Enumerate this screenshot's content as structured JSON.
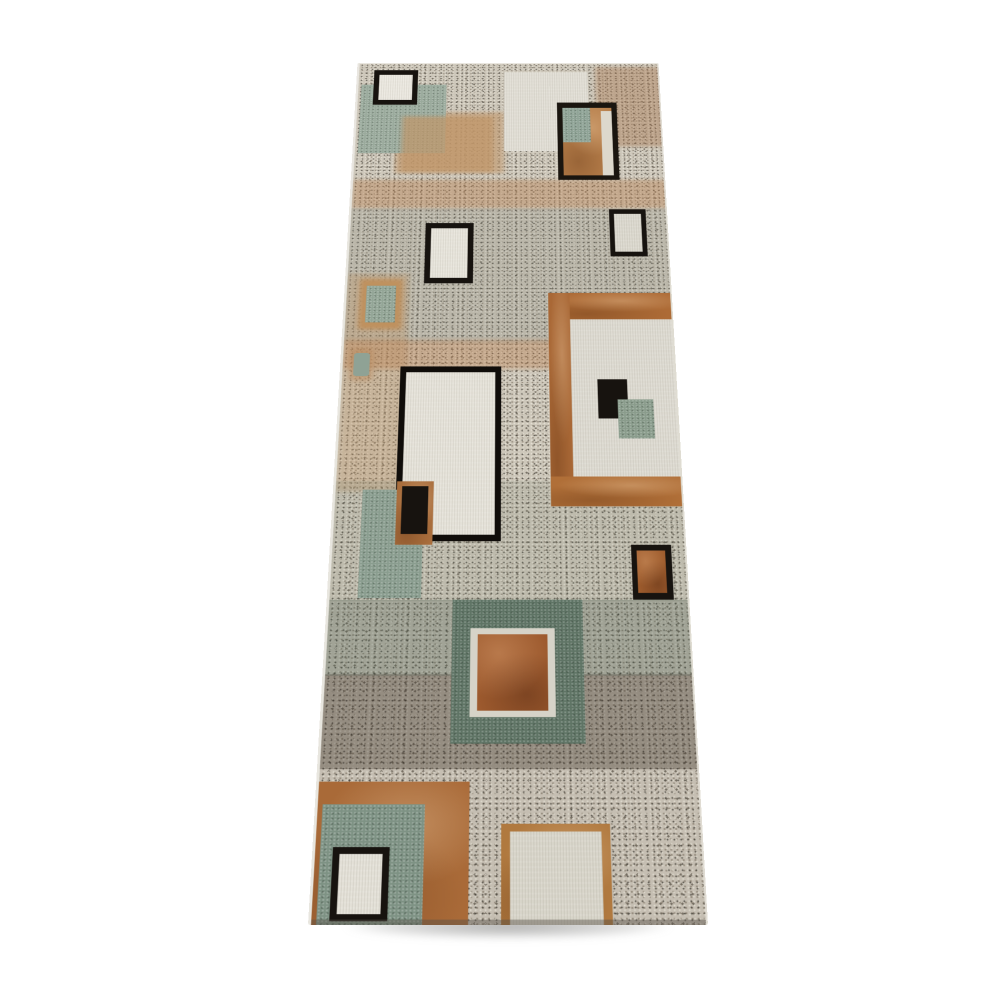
{
  "image": {
    "description": "Product photo of a modern abstract runner rug shown in perspective on a plain white background: overlapping squares and rectangles in sage green, rust brown, tan, cream and black over a speckled grey granite-look field, with tan horizontal bands and a dark speckled band near the lower end.",
    "background_color": "#ffffff"
  },
  "rug": {
    "palette": {
      "speckle_base": "#cdc7ba",
      "cream": "#e6e3da",
      "sage_green": "#8a9d8f",
      "dark_green": "#5f7465",
      "rust": "#9d5a2e",
      "brown": "#ad6b36",
      "tan": "#c29b72",
      "black": "#17130f"
    },
    "elements": [
      {
        "name": "rug-base-speckle",
        "x": 0,
        "y": 0,
        "w": 400,
        "h": 1264,
        "bg": "#cdc7ba",
        "tx": "speckle"
      },
      {
        "name": "top-right-brown-speckle",
        "x": 312,
        "y": 6,
        "w": 88,
        "h": 150,
        "bg": "rgba(164,116,74,0.40)",
        "soft": true
      },
      {
        "name": "top-left-tan-wash",
        "x": 52,
        "y": 92,
        "w": 140,
        "h": 112,
        "bg": "rgba(193,150,104,0.55)",
        "soft": true
      },
      {
        "name": "tan-band-upper",
        "x": 0,
        "y": 216,
        "w": 400,
        "h": 50,
        "bg": "rgba(184,128,80,0.42)",
        "soft": true
      },
      {
        "name": "mid-grey-tint",
        "x": 0,
        "y": 266,
        "w": 400,
        "h": 226,
        "bg": "rgba(116,120,110,0.20)"
      },
      {
        "name": "left-sand-speckle",
        "x": 0,
        "y": 378,
        "w": 76,
        "h": 338,
        "bg": "rgba(190,150,106,0.38)",
        "soft": true
      },
      {
        "name": "tan-band-mid",
        "x": 0,
        "y": 486,
        "w": 254,
        "h": 46,
        "bg": "rgba(184,128,80,0.40)",
        "soft": true
      },
      {
        "name": "lower-green-tint",
        "x": 0,
        "y": 700,
        "w": 400,
        "h": 168,
        "bg": "rgba(110,122,106,0.16)"
      },
      {
        "name": "green-speckle-band",
        "x": 0,
        "y": 866,
        "w": 400,
        "h": 100,
        "bg": "rgba(84,100,86,0.36)"
      },
      {
        "name": "dark-brown-speckle-band",
        "x": 0,
        "y": 964,
        "w": 400,
        "h": 118,
        "bg": "rgba(64,56,46,0.40)"
      },
      {
        "name": "bottom-light-tint",
        "x": 0,
        "y": 1082,
        "w": 400,
        "h": 182,
        "bg": "rgba(124,120,110,0.10)"
      },
      {
        "name": "top-left-green-square",
        "x": 4,
        "y": 40,
        "w": 112,
        "h": 128,
        "bg": "#9aaa9c",
        "tx": "grain"
      },
      {
        "name": "top-left-tan-overlay",
        "x": 60,
        "y": 100,
        "w": 118,
        "h": 102,
        "bg": "rgba(192,150,104,0.70)",
        "soft": true
      },
      {
        "name": "framed-rect-1-border",
        "x": 20,
        "y": 12,
        "w": 58,
        "h": 66,
        "bg": "#17130f"
      },
      {
        "name": "framed-rect-1-fill",
        "x": 27,
        "y": 21,
        "w": 44,
        "h": 48,
        "bg": "#ece9e1",
        "tx": "cream"
      },
      {
        "name": "top-center-cream-rect",
        "x": 192,
        "y": 16,
        "w": 110,
        "h": 148,
        "bg": "#e2dfd6",
        "tx": "cream"
      },
      {
        "name": "framed-rect-2-border",
        "x": 261,
        "y": 74,
        "w": 78,
        "h": 142,
        "bg": "#1a150f"
      },
      {
        "name": "framed-rect-2-tan-fill",
        "x": 268,
        "y": 84,
        "w": 64,
        "h": 124,
        "bg": "#b67e4a",
        "tx": "brownwash"
      },
      {
        "name": "framed-rect-2-green-fill",
        "x": 268,
        "y": 84,
        "w": 36,
        "h": 64,
        "bg": "#8fa396",
        "tx": "grain"
      },
      {
        "name": "framed-rect-2-cream-stripe",
        "x": 318,
        "y": 90,
        "w": 14,
        "h": 118,
        "bg": "#ddd8cc"
      },
      {
        "name": "small-framed-rect-left-border",
        "x": 94,
        "y": 292,
        "w": 60,
        "h": 102,
        "bg": "#17130f"
      },
      {
        "name": "small-framed-rect-left-fill",
        "x": 101,
        "y": 301,
        "w": 46,
        "h": 84,
        "bg": "#e8e5dc",
        "tx": "cream"
      },
      {
        "name": "small-framed-rect-right-border",
        "x": 324,
        "y": 268,
        "w": 46,
        "h": 81,
        "bg": "#17130f"
      },
      {
        "name": "small-framed-rect-right-fill",
        "x": 330,
        "y": 276,
        "w": 34,
        "h": 65,
        "bg": "#dcd9cf",
        "tx": "cream"
      },
      {
        "name": "left-tan-green-chip-border",
        "x": 16,
        "y": 387,
        "w": 52,
        "h": 82,
        "bg": "#bf915e",
        "soft": true
      },
      {
        "name": "left-tan-green-chip-fill",
        "x": 24,
        "y": 398,
        "w": 36,
        "h": 60,
        "bg": "#93a596",
        "tx": "grain"
      },
      {
        "name": "left-sage-dot-ring",
        "x": 9,
        "y": 500,
        "w": 27,
        "h": 50,
        "bg": "rgba(184,138,94,0.55)",
        "r": 6,
        "soft": true
      },
      {
        "name": "left-sage-dot",
        "x": 13,
        "y": 507,
        "w": 19,
        "h": 36,
        "bg": "#8fa295",
        "r": 4
      },
      {
        "name": "large-framed-rect-border",
        "x": 69,
        "y": 528,
        "w": 120,
        "h": 258,
        "bg": "#100d0a"
      },
      {
        "name": "large-framed-rect-fill",
        "x": 76,
        "y": 537,
        "w": 106,
        "h": 240,
        "bg": "#e6e3da",
        "tx": "cream"
      },
      {
        "name": "brown-frame-top-band",
        "x": 248,
        "y": 410,
        "w": 147,
        "h": 43,
        "bg": "#ad6b36",
        "tx": "brownwash"
      },
      {
        "name": "brown-frame-left-band",
        "x": 246,
        "y": 410,
        "w": 26,
        "h": 327,
        "bg": "#a96836",
        "tx": "brownwash"
      },
      {
        "name": "brown-frame-bottom-band",
        "x": 246,
        "y": 694,
        "w": 154,
        "h": 43,
        "bg": "#b06f38",
        "tx": "brownwash"
      },
      {
        "name": "brown-frame-interior-cream",
        "x": 272,
        "y": 453,
        "w": 128,
        "h": 241,
        "bg": "#dedbd2",
        "tx": "cream"
      },
      {
        "name": "interior-black-square",
        "x": 303,
        "y": 548,
        "w": 35,
        "h": 60,
        "bg": "#17130f"
      },
      {
        "name": "interior-green-square",
        "x": 326,
        "y": 579,
        "w": 42,
        "h": 59,
        "bg": "#8a9c8c",
        "tx": "grain"
      },
      {
        "name": "mid-left-green-square",
        "x": 31,
        "y": 713,
        "w": 70,
        "h": 151,
        "bg": "#8a9d8f",
        "tx": "grain"
      },
      {
        "name": "brown-framed-black-rect-border",
        "x": 70,
        "y": 701,
        "w": 42,
        "h": 90,
        "bg": "#a96e3d",
        "tx": "brownwash"
      },
      {
        "name": "brown-framed-black-rect-fill",
        "x": 76,
        "y": 708,
        "w": 30,
        "h": 68,
        "bg": "#17130f"
      },
      {
        "name": "black-framed-brown-rect-border",
        "x": 335,
        "y": 791,
        "w": 45,
        "h": 75,
        "bg": "#17130f"
      },
      {
        "name": "black-framed-brown-rect-fill",
        "x": 341,
        "y": 799,
        "w": 32,
        "h": 58,
        "bg": "#9e5c2d",
        "tx": "rust"
      },
      {
        "name": "center-green-block",
        "x": 136,
        "y": 866,
        "w": 143,
        "h": 185,
        "bg": "#5f7465",
        "tx": "grain"
      },
      {
        "name": "center-white-frame",
        "x": 156,
        "y": 904,
        "w": 92,
        "h": 114,
        "bg": "#d6d3c8"
      },
      {
        "name": "center-rust-square",
        "x": 164,
        "y": 912,
        "w": 76,
        "h": 98,
        "bg": "#9d5a2e",
        "tx": "rust"
      },
      {
        "name": "bottom-left-brown-corner",
        "x": 0,
        "y": 1097,
        "w": 157,
        "h": 167,
        "bg": "#a96a38",
        "tx": "brownwash"
      },
      {
        "name": "bottom-left-green-square",
        "x": 5,
        "y": 1124,
        "w": 106,
        "h": 140,
        "bg": "#7e9284",
        "tx": "grain"
      },
      {
        "name": "bottom-framed-rect-border",
        "x": 18,
        "y": 1174,
        "w": 58,
        "h": 84,
        "bg": "#17130f"
      },
      {
        "name": "bottom-framed-rect-fill",
        "x": 25,
        "y": 1182,
        "w": 44,
        "h": 68,
        "bg": "#e4e1d8",
        "tx": "cream"
      },
      {
        "name": "bottom-center-brown-border",
        "x": 190,
        "y": 1147,
        "w": 112,
        "h": 117,
        "bg": "#b0793f",
        "tx": "brownwash"
      },
      {
        "name": "bottom-center-cream-fill",
        "x": 199,
        "y": 1156,
        "w": 94,
        "h": 108,
        "bg": "#d9d6cb",
        "tx": "cream"
      },
      {
        "name": "rug-bottom-edge-shade",
        "x": 0,
        "y": 1256,
        "w": 400,
        "h": 8,
        "bg": "rgba(88,82,74,0.45)"
      }
    ]
  }
}
